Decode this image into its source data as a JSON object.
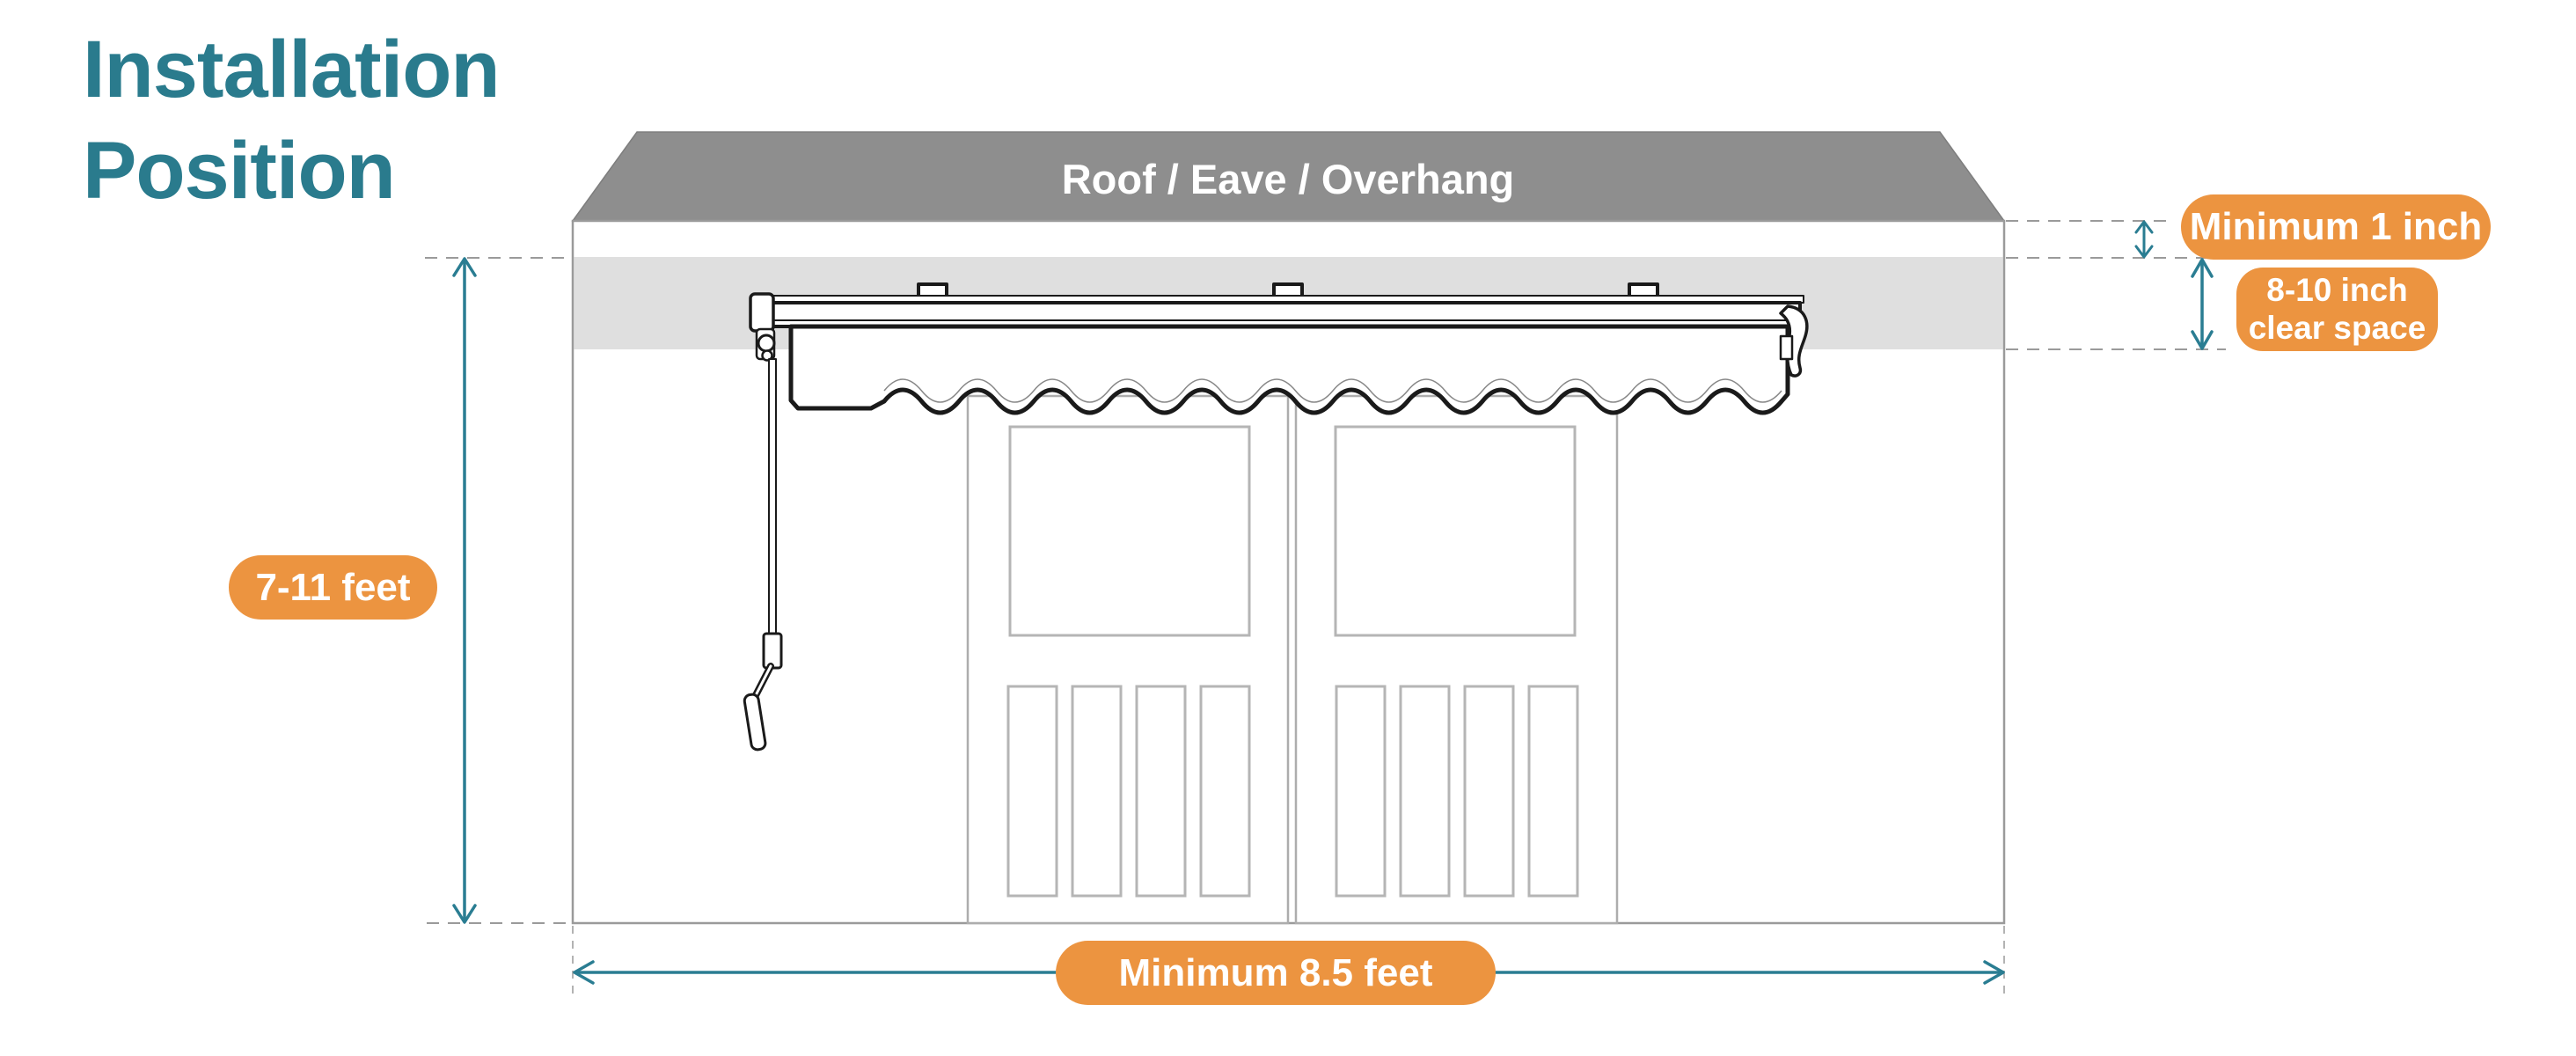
{
  "title": {
    "line1": "Installation",
    "line2": "Position"
  },
  "diagram": {
    "roof_label": "Roof / Eave / Overhang",
    "annotations": {
      "wall_height": "7-11 feet",
      "roof_clearance": "Minimum 1 inch",
      "clear_space_line1": "8-10 inch",
      "clear_space_line2": "clear space",
      "min_width": "Minimum 8.5 feet"
    }
  },
  "colors": {
    "title_teal": "#2a7b8d",
    "dimension_teal": "#2a7d92",
    "label_orange": "#ec9440",
    "roof_gray": "#8e8e8e",
    "clear_band_gray": "#dfdfdf",
    "outline_gray": "#9a9a9a",
    "door_gray": "#b5b5b5",
    "awning_black": "#1a1a1a"
  }
}
